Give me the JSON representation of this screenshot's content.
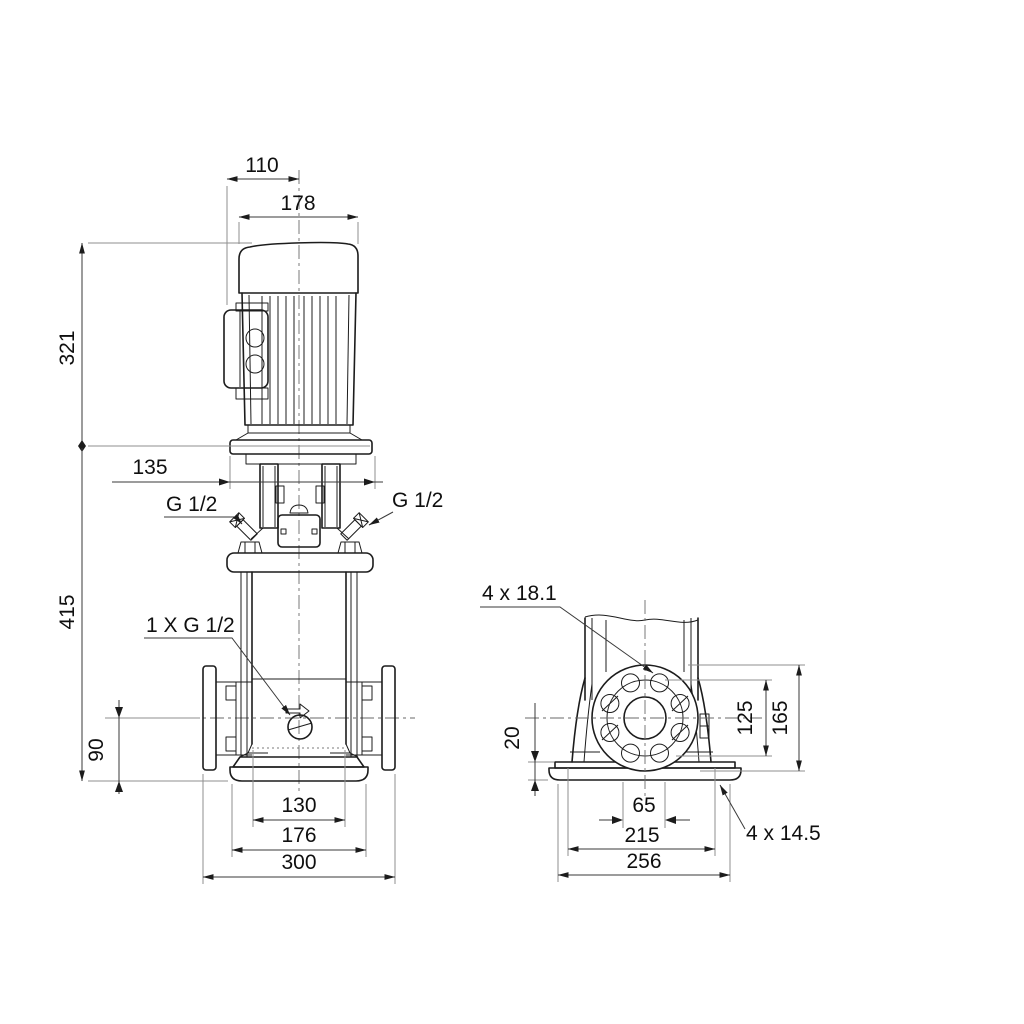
{
  "drawing": {
    "title": "pump-dimensional-drawing",
    "subject": "vertical multistage centrifugal pump with motor, two orthographic views",
    "front_view": {
      "dim_motor_cl_to_box": "110",
      "dim_motor_width": "178",
      "dim_motor_height": "321",
      "dim_head_flange_width": "135",
      "dim_pump_height": "415",
      "dim_port_height": "90",
      "dim_chamber_width": "130",
      "dim_head_width": "176",
      "dim_port_span": "300",
      "label_vent_left": "G 1/2",
      "label_vent_right": "G 1/2",
      "label_drain": "1 X G 1/2"
    },
    "side_view": {
      "label_flange_holes": "4 x 18.1",
      "dim_base_thickness": "20",
      "dim_bolt_circle": "125",
      "dim_flange_od": "165",
      "dim_bore": "65",
      "dim_base_holes_span": "215",
      "dim_base_width": "256",
      "label_base_holes": "4 x 14.5"
    }
  }
}
